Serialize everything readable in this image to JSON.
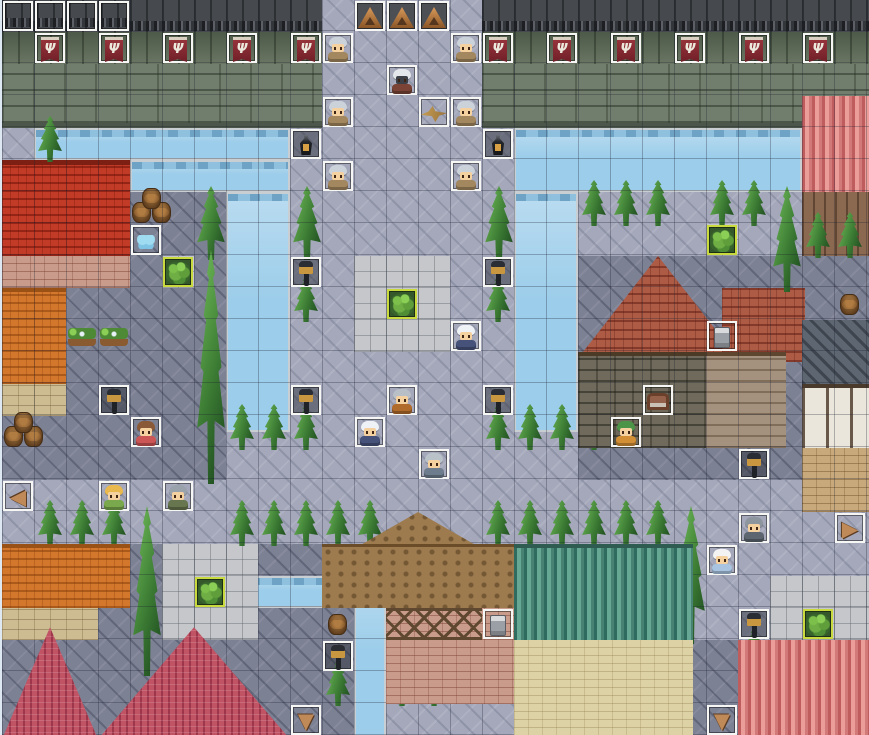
{
  "meta": {
    "scene": "rpg-town-map-editor-view",
    "map_cols": 27,
    "map_rows": 23,
    "tile_px": 32,
    "offset_x": 2,
    "grid_visible": true
  },
  "palette": {
    "cobble_light": "#a4a8ba",
    "cobble_dark": "#7d8194",
    "water": "#9ccdea",
    "wall_face": "#727e6d",
    "wall_top": "#46494d",
    "banner_red": "#96333b",
    "event_border": "#f6f6f4",
    "garden_border": "#c9da3e",
    "roof_red": "#c23b27",
    "roof_orange": "#d3772c",
    "roof_salmon": "#d98080",
    "roof_crimson": "#c05364",
    "roof_brown": "#9d7b4f",
    "roof_green": "#4c8a7a",
    "roof_rust": "#ae5b45"
  },
  "regions": [
    {
      "k": "cobble-light",
      "x": 0,
      "y": 0,
      "w": 27.2,
      "h": 23
    },
    {
      "k": "cobble-dark",
      "x": 0,
      "y": 6,
      "w": 7,
      "h": 9
    },
    {
      "k": "cobble-dark",
      "x": 18,
      "y": 8,
      "w": 9.2,
      "h": 7
    },
    {
      "k": "cobble-dark",
      "x": 0,
      "y": 17,
      "w": 11.5,
      "h": 6
    },
    {
      "k": "cobble-dark",
      "x": 21.5,
      "y": 20,
      "w": 1.5,
      "h": 3
    },
    {
      "k": "wall-face",
      "x": 0,
      "y": 2,
      "w": 10,
      "h": 2
    },
    {
      "k": "wall-face",
      "x": 15,
      "y": 2,
      "w": 12.2,
      "h": 2
    },
    {
      "k": "wall-moss",
      "x": 0,
      "y": 1,
      "w": 10,
      "h": 1
    },
    {
      "k": "wall-moss",
      "x": 15,
      "y": 1,
      "w": 12.2,
      "h": 1
    },
    {
      "k": "wall-top",
      "x": 0,
      "y": 0,
      "w": 10,
      "h": 1
    },
    {
      "k": "wall-top",
      "x": 15,
      "y": 0,
      "w": 12.2,
      "h": 1
    },
    {
      "k": "water",
      "x": 1,
      "y": 4,
      "w": 8,
      "h": 1
    },
    {
      "k": "water",
      "x": 4,
      "y": 5,
      "w": 5,
      "h": 1
    },
    {
      "k": "water",
      "x": 7,
      "y": 6,
      "w": 2,
      "h": 7.5
    },
    {
      "k": "water",
      "x": 16,
      "y": 4,
      "w": 9,
      "h": 2
    },
    {
      "k": "water",
      "x": 16,
      "y": 6,
      "w": 2,
      "h": 7.5
    },
    {
      "k": "water",
      "x": 7,
      "y": 18,
      "w": 4.2,
      "h": 1
    },
    {
      "k": "water",
      "x": 11,
      "y": 18,
      "w": 1,
      "h": 5.2
    },
    {
      "k": "stone",
      "x": 11,
      "y": 8,
      "w": 3,
      "h": 3
    },
    {
      "k": "stone",
      "x": 5,
      "y": 17,
      "w": 3,
      "h": 3
    },
    {
      "k": "stone",
      "x": 24,
      "y": 18,
      "w": 3.2,
      "h": 3
    },
    {
      "k": "stone",
      "x": 5,
      "y": 8,
      "w": 1,
      "h": 1
    },
    {
      "k": "stone",
      "x": 22,
      "y": 7,
      "w": 1,
      "h": 1
    },
    {
      "k": "roof-red",
      "x": 0,
      "y": 5,
      "w": 4,
      "h": 3
    },
    {
      "k": "wall-brick",
      "x": 0,
      "y": 8,
      "w": 4,
      "h": 1
    },
    {
      "k": "roof-orange",
      "x": 0,
      "y": 9,
      "w": 2,
      "h": 3
    },
    {
      "k": "wall-tan",
      "x": 0,
      "y": 12,
      "w": 2,
      "h": 1
    },
    {
      "k": "roof-salmon",
      "x": 25,
      "y": 3,
      "w": 2.2,
      "h": 3
    },
    {
      "k": "wall-wood",
      "x": 25,
      "y": 6,
      "w": 2.2,
      "h": 2
    },
    {
      "k": "roof-rust",
      "x": 18,
      "y": 8,
      "w": 5,
      "h": 3.2,
      "c": "clip-gable"
    },
    {
      "k": "roof-rust",
      "x": 22.5,
      "y": 9,
      "w": 2.6,
      "h": 2.3
    },
    {
      "k": "wall-sdark",
      "x": 18,
      "y": 11,
      "w": 4,
      "h": 3
    },
    {
      "k": "wall-smid",
      "x": 22,
      "y": 11,
      "w": 2.5,
      "h": 3
    },
    {
      "k": "roof-darkgray",
      "x": 25,
      "y": 10,
      "w": 2.2,
      "h": 2
    },
    {
      "k": "wall-white",
      "x": 25,
      "y": 12,
      "w": 2.2,
      "h": 2
    },
    {
      "k": "wall-brick2",
      "x": 25,
      "y": 14,
      "w": 2.2,
      "h": 2
    },
    {
      "k": "roof-brown",
      "x": 11,
      "y": 16,
      "w": 4,
      "h": 1.15,
      "c": "clip-gable"
    },
    {
      "k": "roof-brown",
      "x": 10,
      "y": 17,
      "w": 7,
      "h": 2
    },
    {
      "k": "wall-brick",
      "x": 12,
      "y": 19,
      "w": 4.5,
      "h": 3
    },
    {
      "k": "timber",
      "x": 12,
      "y": 19,
      "w": 3,
      "h": 1
    },
    {
      "k": "roof-green",
      "x": 16,
      "y": 17,
      "w": 5.6,
      "h": 3
    },
    {
      "k": "wall-cream",
      "x": 16,
      "y": 20,
      "w": 5.6,
      "h": 3
    },
    {
      "k": "roof-orange",
      "x": 0,
      "y": 17,
      "w": 4,
      "h": 2
    },
    {
      "k": "wall-tan",
      "x": 0,
      "y": 19,
      "w": 3,
      "h": 1
    },
    {
      "k": "roof-crimson",
      "x": 0,
      "y": 19.6,
      "w": 3,
      "h": 3.5,
      "c": "clip-gable"
    },
    {
      "k": "roof-crimson",
      "x": 3,
      "y": 19.6,
      "w": 6,
      "h": 3.5,
      "c": "clip-gable"
    },
    {
      "k": "roof-salmon",
      "x": 23,
      "y": 20,
      "w": 4.2,
      "h": 3
    }
  ],
  "trees": {
    "small": [
      [
        1,
        4
      ],
      [
        18,
        6
      ],
      [
        19,
        6
      ],
      [
        20,
        6
      ],
      [
        22,
        6
      ],
      [
        23,
        6
      ],
      [
        9,
        9
      ],
      [
        15,
        9
      ],
      [
        7,
        13
      ],
      [
        8,
        13
      ],
      [
        9,
        13
      ],
      [
        15,
        13
      ],
      [
        16,
        13
      ],
      [
        17,
        13
      ],
      [
        18,
        13
      ],
      [
        25,
        7
      ],
      [
        26,
        7
      ],
      [
        1,
        16
      ],
      [
        2,
        16
      ],
      [
        3,
        16
      ],
      [
        7,
        16
      ],
      [
        8,
        16
      ],
      [
        9,
        16
      ],
      [
        10,
        16
      ],
      [
        11,
        16
      ],
      [
        15,
        16
      ],
      [
        16,
        16
      ],
      [
        17,
        16
      ],
      [
        18,
        16
      ],
      [
        19,
        16
      ],
      [
        20,
        16
      ],
      [
        10,
        21
      ],
      [
        12,
        21
      ],
      [
        13,
        21
      ],
      [
        23,
        20
      ]
    ],
    "tall": [
      [
        6,
        6,
        2
      ],
      [
        9,
        6,
        2
      ],
      [
        15,
        6,
        2
      ],
      [
        6,
        8,
        7
      ],
      [
        4,
        16,
        5
      ],
      [
        21,
        16,
        4
      ],
      [
        24,
        6,
        3
      ]
    ]
  },
  "decor": [
    [
      "chimney",
      2,
      5
    ],
    [
      "chimney",
      1,
      9
    ],
    [
      "chimney",
      2,
      17
    ],
    [
      "chimney",
      19,
      17
    ],
    [
      "chimney",
      24,
      20
    ],
    [
      "chimney",
      26,
      3
    ],
    [
      "window-g",
      2,
      8
    ],
    [
      "window-g",
      3,
      8
    ],
    [
      "window-g",
      0,
      12
    ],
    [
      "window-g",
      1,
      12
    ],
    [
      "window-g",
      19,
      11
    ],
    [
      "window-g",
      12,
      20
    ],
    [
      "window-g",
      13,
      20
    ],
    [
      "window-g",
      14,
      20
    ],
    [
      "window-o",
      21,
      11
    ],
    [
      "window-o",
      17,
      20
    ],
    [
      "window-o",
      19,
      20
    ],
    [
      "window-o",
      20,
      20
    ],
    [
      "window-p",
      26,
      6
    ],
    [
      "window-p",
      23,
      11
    ],
    [
      "window-p",
      22,
      12
    ],
    [
      "window-p",
      26,
      13
    ],
    [
      "awning",
      25,
      6
    ],
    [
      "awning",
      23,
      12
    ],
    [
      "awning",
      0,
      19
    ],
    [
      "flowerbed",
      15,
      21
    ],
    [
      "planter",
      2,
      10
    ],
    [
      "planter",
      3,
      10
    ],
    [
      "flowerpots",
      17,
      22
    ],
    [
      "door",
      18,
      12
    ],
    [
      "barrel",
      10,
      19
    ],
    [
      "barrel",
      26,
      9
    ],
    [
      "barrels3",
      4,
      6
    ],
    [
      "barrels3",
      0,
      13
    ],
    [
      "barrelsbig",
      25,
      20
    ]
  ],
  "events": [
    [
      "battlement",
      0,
      0
    ],
    [
      "battlement",
      1,
      0
    ],
    [
      "battlement",
      2,
      0
    ],
    [
      "battlement",
      3,
      0
    ],
    [
      "spike",
      11,
      0
    ],
    [
      "spike",
      12,
      0
    ],
    [
      "spike",
      13,
      0
    ],
    [
      "banner",
      1,
      1
    ],
    [
      "banner",
      3,
      1
    ],
    [
      "banner",
      5,
      1
    ],
    [
      "banner",
      7,
      1
    ],
    [
      "banner",
      9,
      1
    ],
    [
      "banner",
      15,
      1
    ],
    [
      "banner",
      17,
      1
    ],
    [
      "banner",
      19,
      1
    ],
    [
      "banner",
      21,
      1
    ],
    [
      "banner",
      23,
      1
    ],
    [
      "banner",
      25,
      1
    ],
    [
      "knight",
      10,
      1
    ],
    [
      "knight",
      14,
      1
    ],
    [
      "knight",
      10,
      3
    ],
    [
      "knight",
      14,
      3
    ],
    [
      "knight",
      10,
      5
    ],
    [
      "knight",
      14,
      5
    ],
    [
      "death-knight",
      12,
      2
    ],
    [
      "hawk",
      13,
      3
    ],
    [
      "bell",
      9,
      4
    ],
    [
      "bell",
      15,
      4
    ],
    [
      "lamp",
      9,
      8
    ],
    [
      "lamp",
      15,
      8
    ],
    [
      "lamp",
      9,
      12
    ],
    [
      "lamp",
      15,
      12
    ],
    [
      "lamp",
      3,
      12
    ],
    [
      "lamp",
      23,
      14
    ],
    [
      "lamp",
      23,
      19
    ],
    [
      "lamp",
      10,
      20
    ],
    [
      "butterfly",
      4,
      7
    ],
    [
      "bush",
      5,
      8
    ],
    [
      "bush",
      22,
      7
    ],
    [
      "bush",
      12,
      9
    ],
    [
      "bush",
      6,
      18
    ],
    [
      "bush",
      25,
      19
    ],
    [
      "chimney-ev",
      22,
      10
    ],
    [
      "chimney-ev",
      15,
      19
    ],
    [
      "hatch",
      20,
      12
    ],
    [
      "door-ev",
      18,
      21
    ],
    [
      "sign-left",
      0,
      15
    ],
    [
      "sign-right",
      26,
      16
    ],
    [
      "sign-down",
      9,
      22
    ],
    [
      "sign-down",
      22,
      22
    ],
    [
      "warrior",
      12,
      12
    ],
    [
      "nun",
      14,
      10
    ],
    [
      "nun",
      11,
      13
    ],
    [
      "soldier",
      13,
      14
    ],
    [
      "maid",
      4,
      13
    ],
    [
      "kid",
      3,
      15
    ],
    [
      "guard",
      5,
      15
    ],
    [
      "villager",
      19,
      13
    ],
    [
      "bonnet-girl",
      22,
      17
    ],
    [
      "armor-soldier",
      23,
      16
    ]
  ],
  "sprites": {
    "characters": {
      "knight": {
        "hat": "#ccd2da",
        "body": "#a3875f"
      },
      "death-knight": {
        "hat": "#e3e6ea",
        "body": "#7a4335",
        "face": "#3c3f45"
      },
      "warrior": {
        "hat": "#b9bfc7",
        "body": "#b06a2a"
      },
      "nun": {
        "hat": "#eef2f6",
        "body": "#46527a"
      },
      "soldier": {
        "hat": "#b9c1c9",
        "body": "#6e7d8e"
      },
      "maid": {
        "hat": "#8a5a38",
        "body": "#cc5555"
      },
      "kid": {
        "hat": "#e9b94d",
        "body": "#79a94c"
      },
      "guard": {
        "hat": "#9aa2ac",
        "body": "#67764f"
      },
      "villager": {
        "hat": "#4c9447",
        "body": "#d28f35"
      },
      "bonnet-girl": {
        "hat": "#f3f3f3",
        "body": "#a8c4e0"
      },
      "armor-soldier": {
        "hat": "#8d969e",
        "body": "#5d6670"
      }
    },
    "sign_glyphs": {
      "sign-left": "◀",
      "sign-right": "▶",
      "sign-down": "▼"
    },
    "banner_emblem": "Ψ"
  }
}
